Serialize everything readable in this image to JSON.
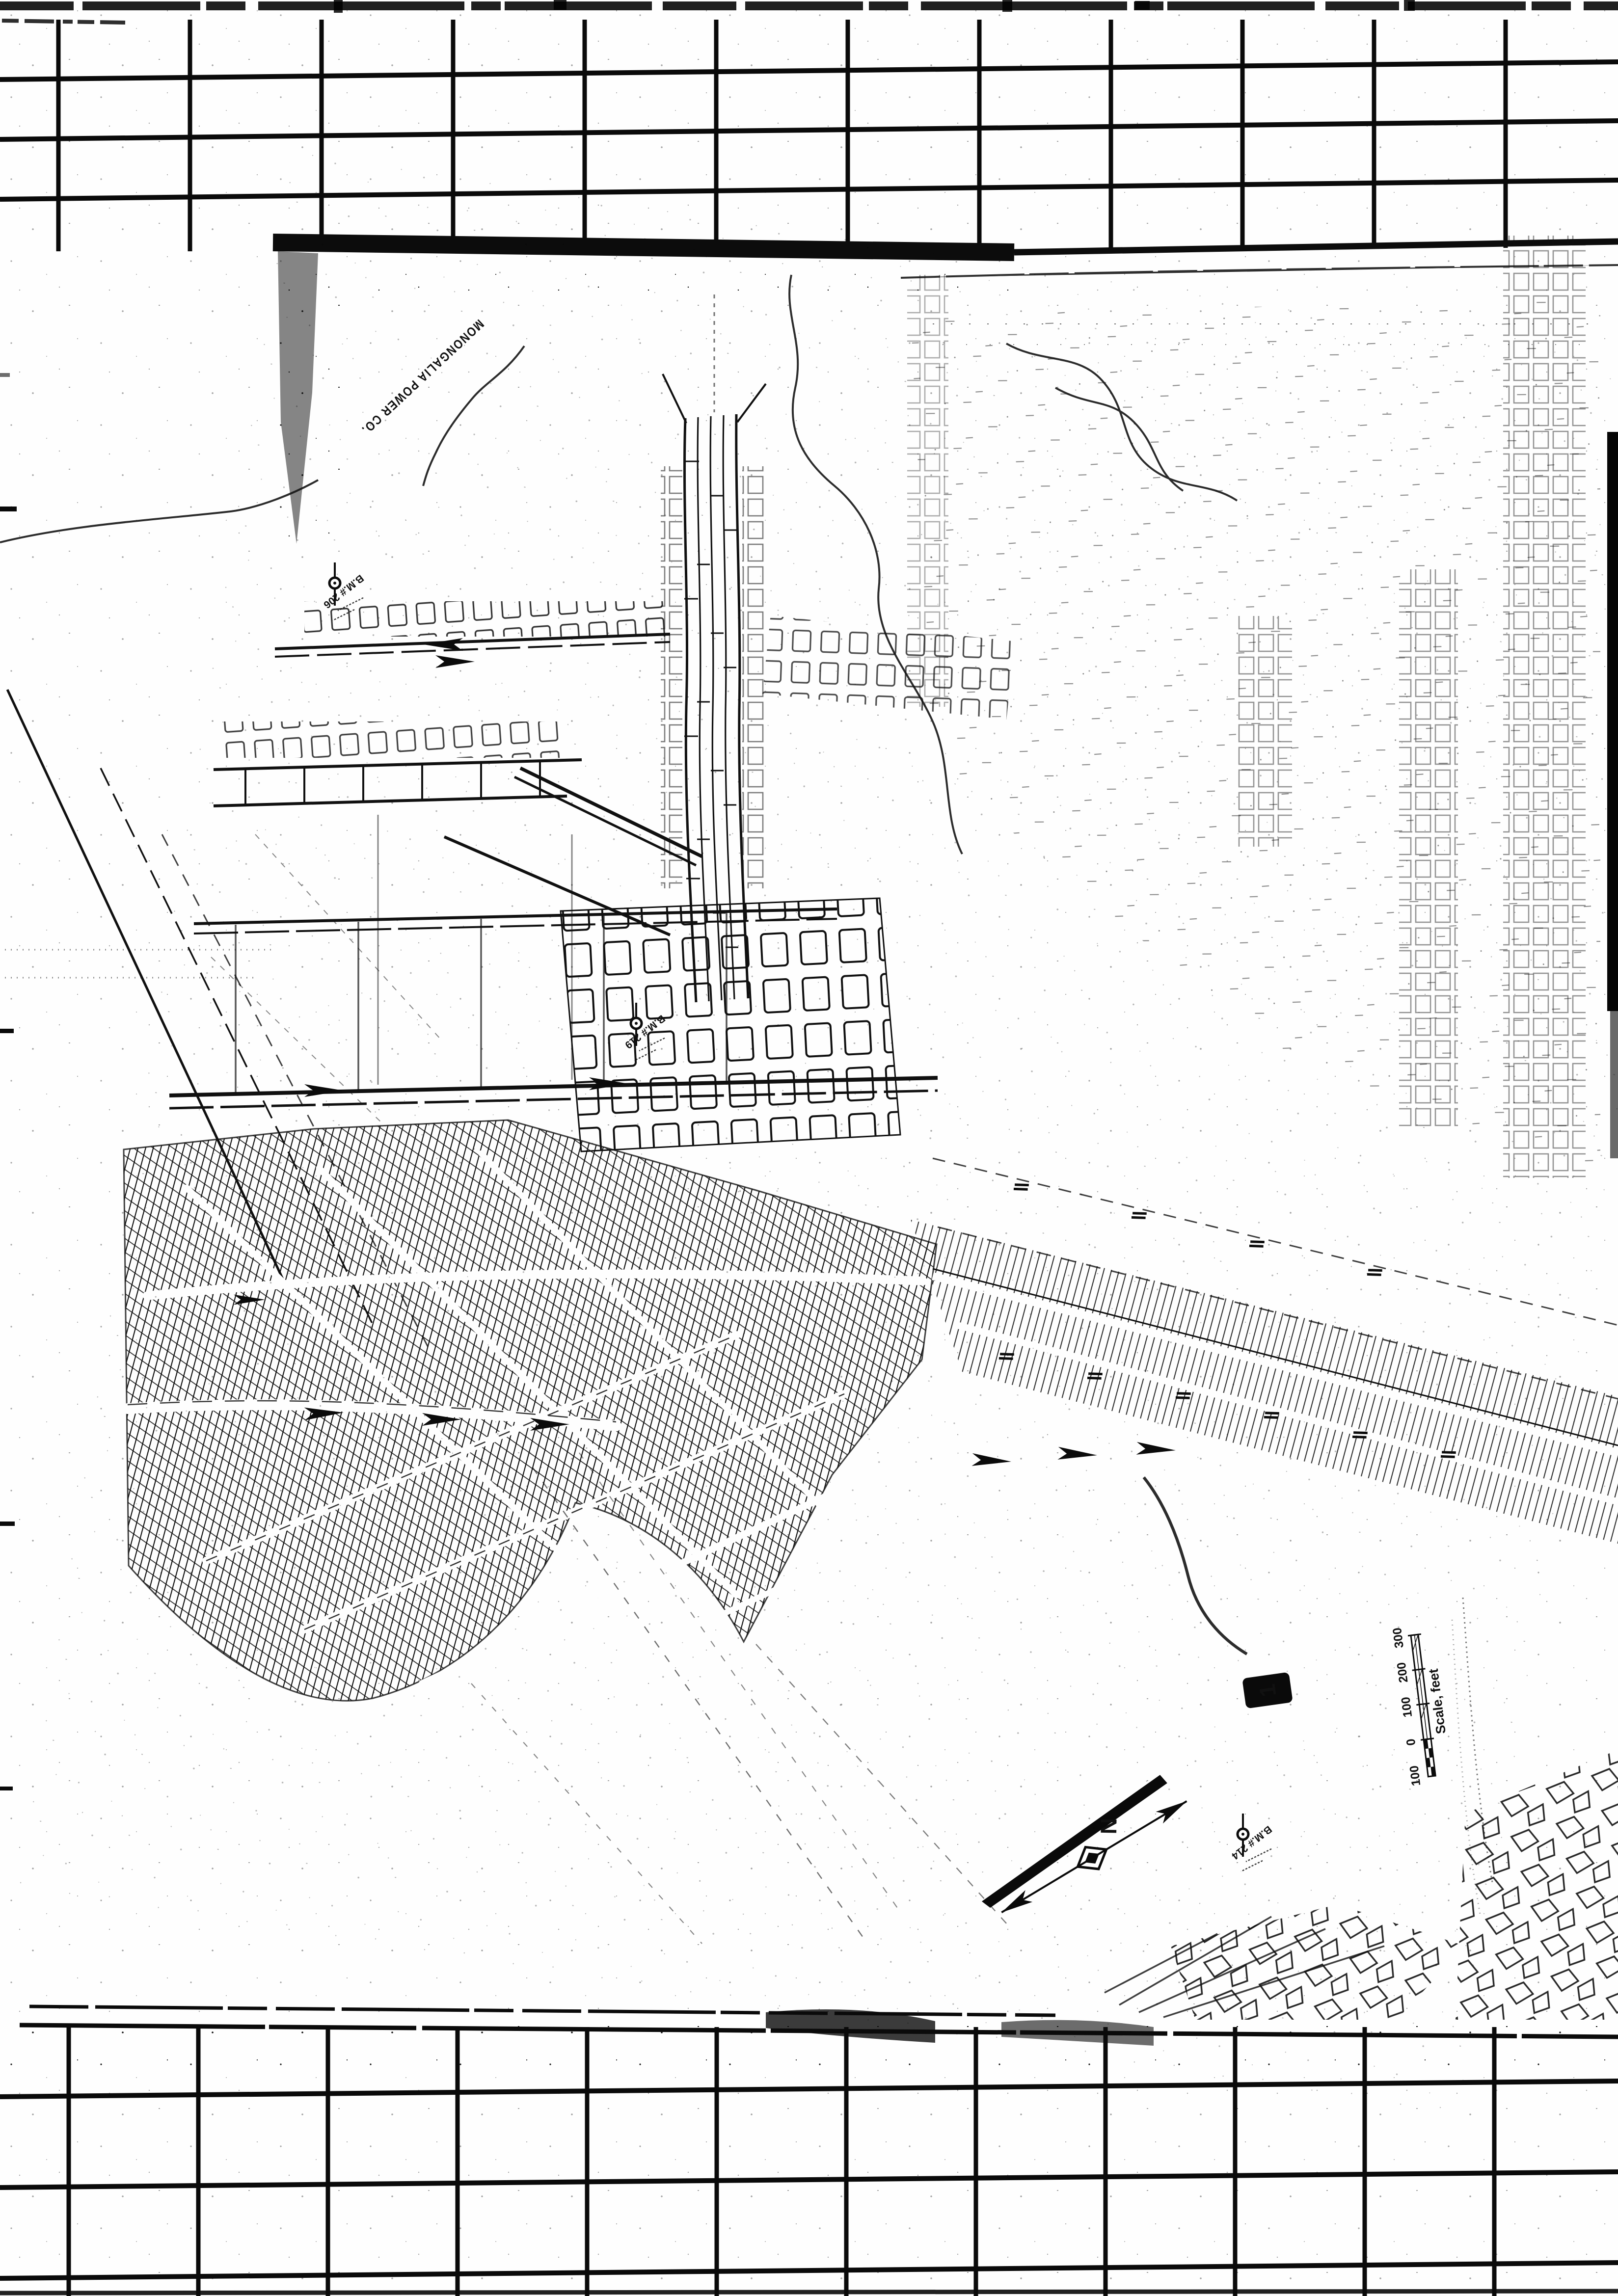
{
  "map": {
    "title": "MONONGALIA POWER CO.",
    "sheet_number": "1",
    "compass": {
      "north_label": "N"
    },
    "scale_bar": {
      "tick_labels": [
        "300",
        "200",
        "100",
        "0",
        "100"
      ],
      "caption": "Scale, feet"
    },
    "benchmarks": [
      {
        "label": "B.M.# 206"
      },
      {
        "label": "B.M.# 219"
      },
      {
        "label": "B.M.# 214"
      }
    ],
    "ink_color": "#0d0d0d",
    "paper_color": "#fefefe"
  }
}
